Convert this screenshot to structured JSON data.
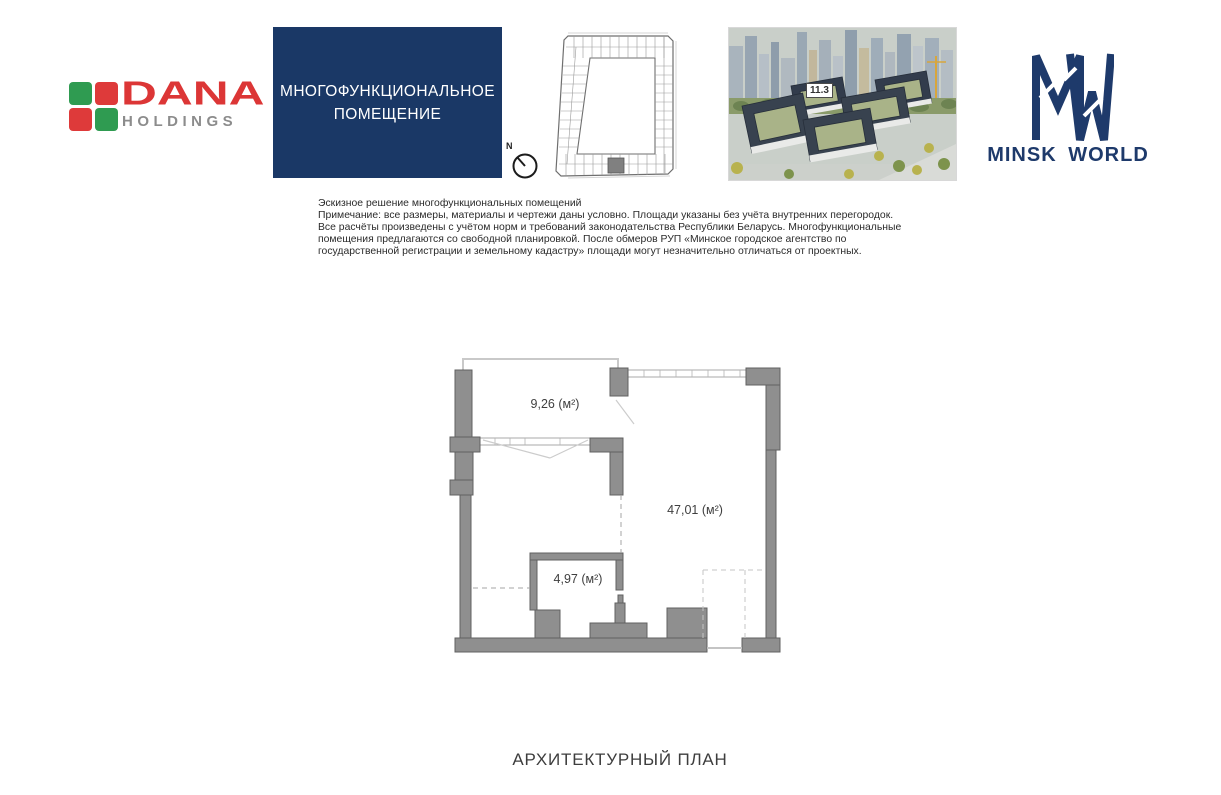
{
  "brand": {
    "dana": {
      "name": "DANA",
      "subtitle": "HOLDINGS",
      "name_color": "#dc3636",
      "subtitle_color": "#8c8c8c",
      "square_colors": {
        "top_left": "#2f9b51",
        "top_right": "#de3a3a",
        "bottom_left": "#de3a3a",
        "bottom_right": "#2f9b51"
      }
    },
    "minsk_world": {
      "text": "MINSK WORLD",
      "color": "#1e3a6b"
    }
  },
  "header": {
    "title_box": {
      "line1": "МНОГОФУНКЦИОНАЛЬНОЕ",
      "line2": "ПОМЕЩЕНИЕ",
      "bg_color": "#1a3866"
    },
    "compass": {
      "label": "N"
    },
    "site_render": {
      "building_label": "11.3"
    }
  },
  "disclaimer": {
    "lines": [
      "Эскизное решение многофункциональных помещений",
      "Примечание: все размеры, материалы и чертежи даны условно. Площади указаны без учёта внутренних перегородок.",
      "Все расчёты произведены с учётом норм и требований законодательства Республики Беларусь. Многофункциональные",
      "помещения предлагаются со свободной планировкой. После обмеров РУП «Минское городское агентство по",
      "государственной регистрации и земельному кадастру» площади могут незначительно отличаться от проектных."
    ]
  },
  "floor_plan": {
    "wall_color": "#8f8f8f",
    "rooms": [
      {
        "name": "balcony",
        "area_label": "9,26 (м²)"
      },
      {
        "name": "main-room",
        "area_label": "47,01 (м²)"
      },
      {
        "name": "storage",
        "area_label": "4,97 (м²)"
      }
    ]
  },
  "footer": {
    "title": "АРХИТЕКТУРНЫЙ ПЛАН"
  }
}
